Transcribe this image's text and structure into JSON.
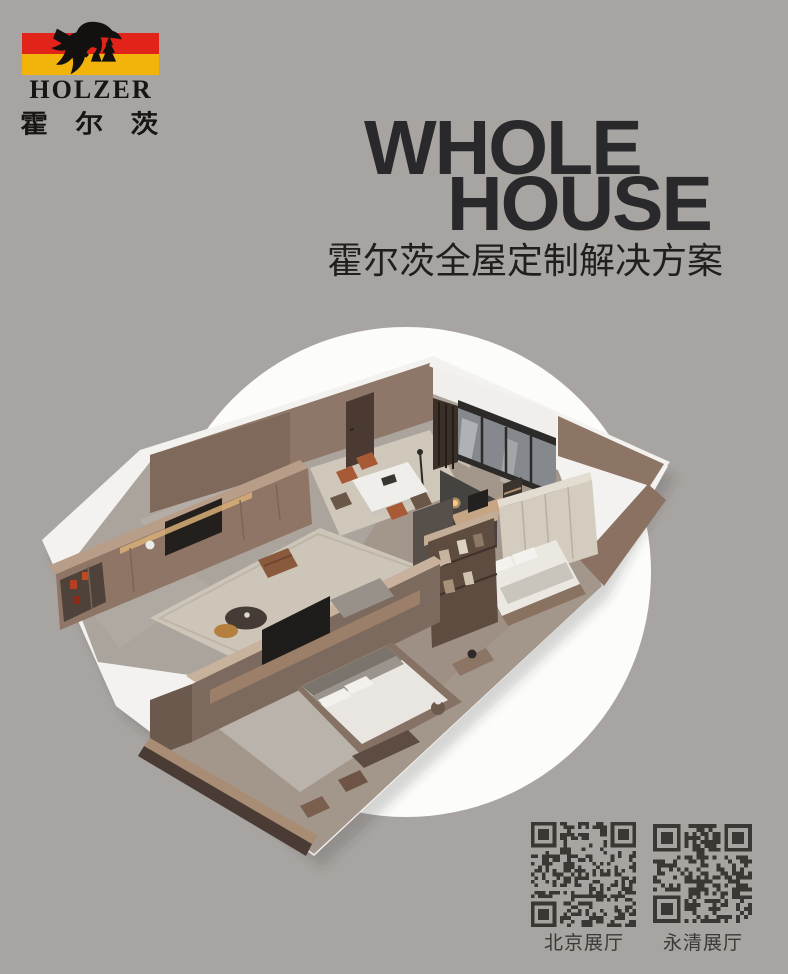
{
  "canvas": {
    "width": 788,
    "height": 974,
    "background_color": "#a8a4a1"
  },
  "logo": {
    "brand_latin": "HOLZER",
    "brand_cn": "霍尔茨",
    "figure_icon": "lumberjack-with-axe-and-trees-silhouette",
    "stripe_red": "#e2231a",
    "stripe_yellow": "#f2b40a",
    "text_color": "#171514"
  },
  "headline": {
    "line1": "WHOLE",
    "line2": "HOUSE",
    "color": "#29282a",
    "subtitle": "霍尔茨全屋定制解决方案",
    "subtitle_color": "#211f1e"
  },
  "hero": {
    "shape": "white-circle",
    "circle_color": "#fcfcfb",
    "illustration": "isometric-apartment-cutaway-render",
    "palette": {
      "wood_wall": "#957d6d",
      "wood_cap": "#c9b29d",
      "ceiling_white": "#f4f2ef",
      "stone_floor": "#aba49c",
      "plank_floor": "#a3968a",
      "rug": "#ccc5b8",
      "bedding": "#e9e6e1",
      "glass": "#85888c",
      "accent_red": "#b43a20",
      "lamp_warm": "#ffc97d"
    }
  },
  "qr_section": {
    "module_color": "#3a3734",
    "items": [
      {
        "id": "beijing",
        "label": "北京展厅"
      },
      {
        "id": "yongqing",
        "label": "永清展厅"
      }
    ]
  }
}
